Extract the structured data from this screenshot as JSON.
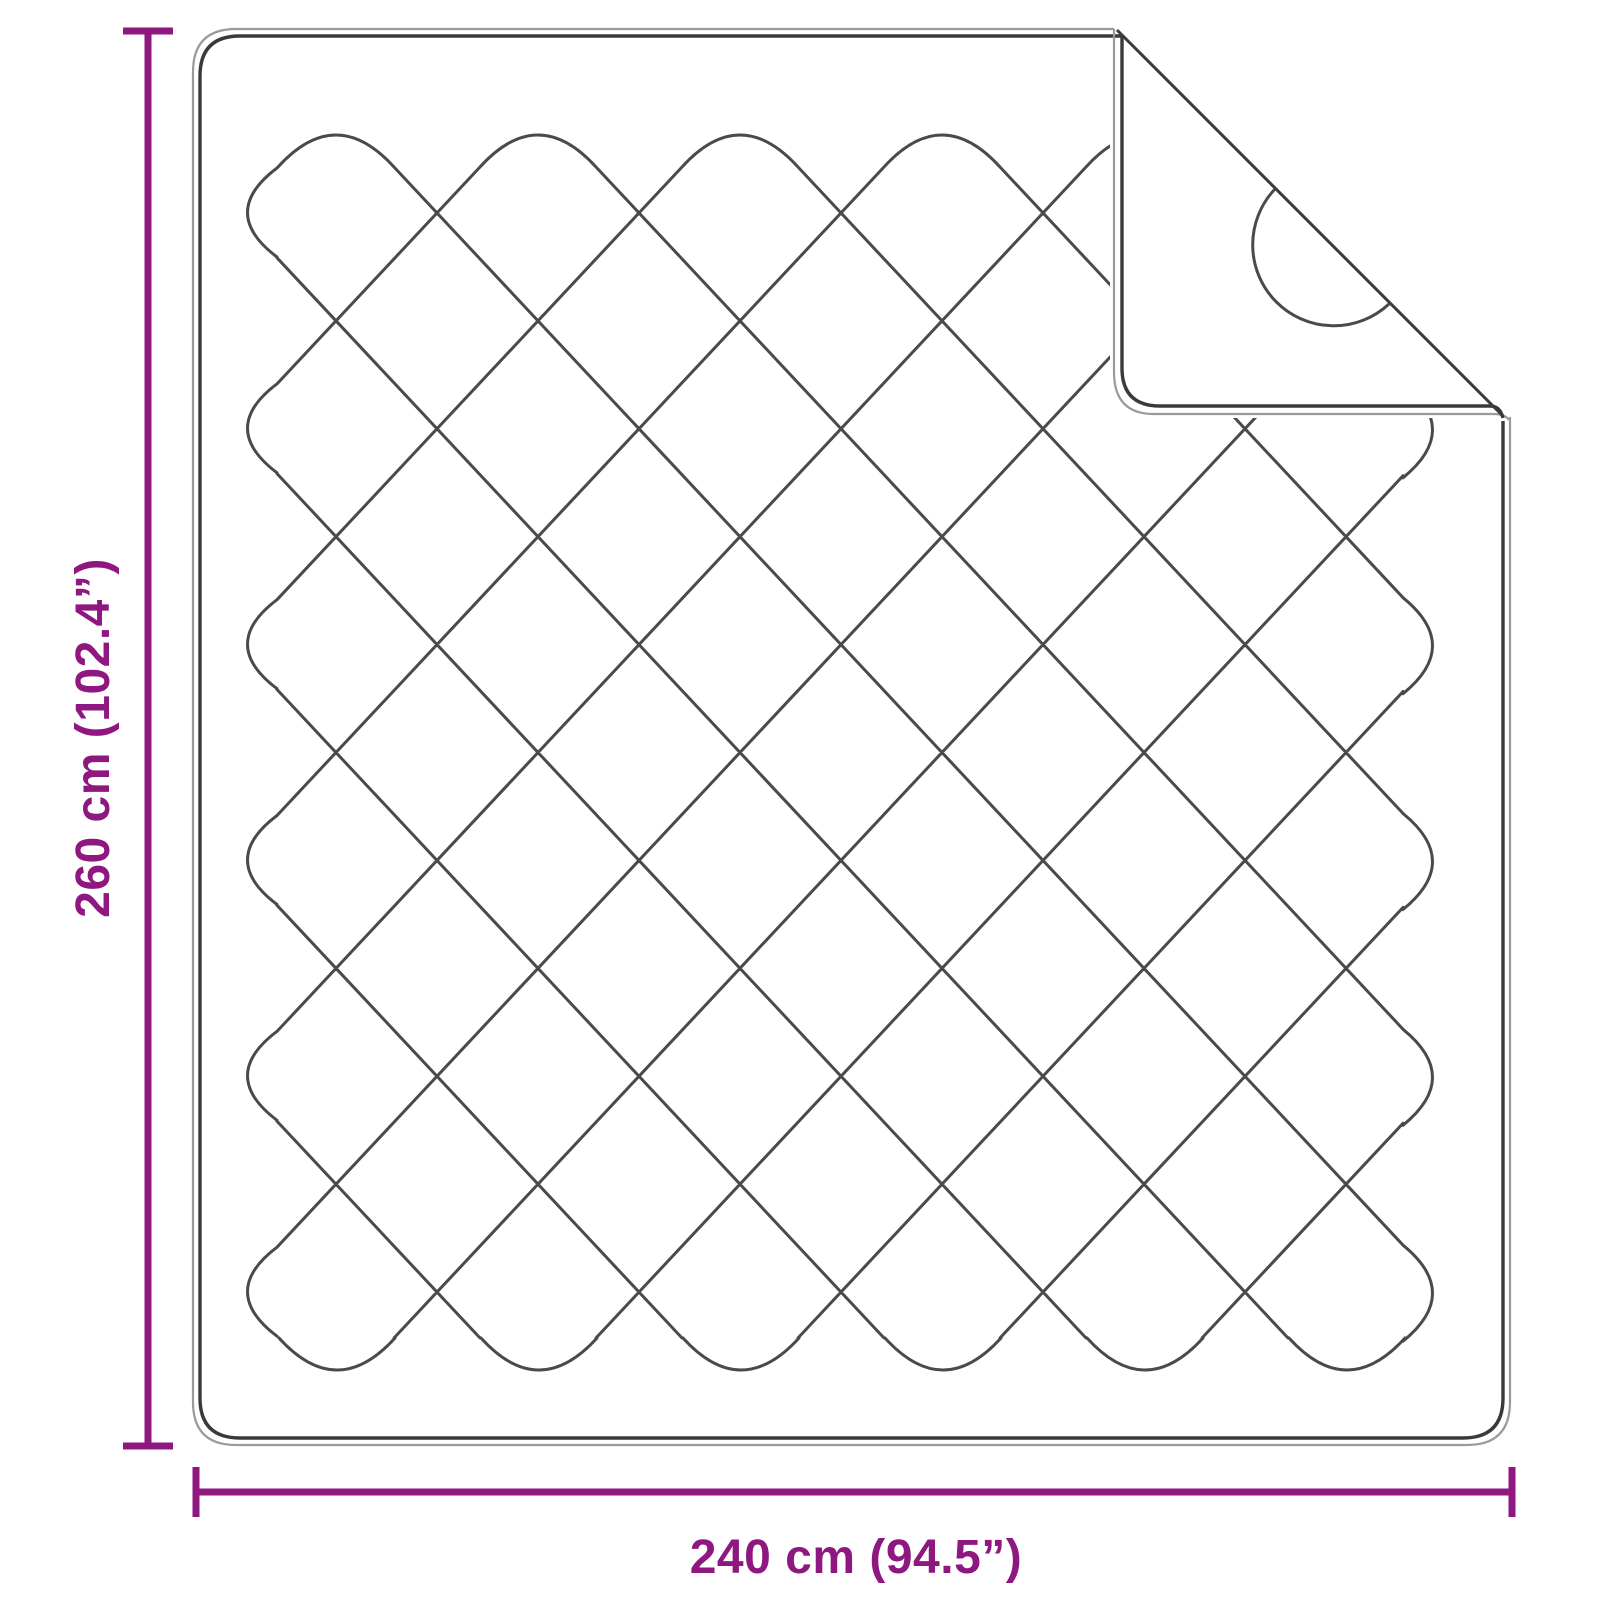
{
  "diagram": {
    "height_label": "260 cm (102.4”)",
    "width_label": "240 cm (94.5”)",
    "colors": {
      "dimension": "#8E1780",
      "outline_dark": "#3a3a3a",
      "outline_light": "#9a9a9a",
      "stitch": "#4a4a4a",
      "background": "#ffffff"
    }
  }
}
